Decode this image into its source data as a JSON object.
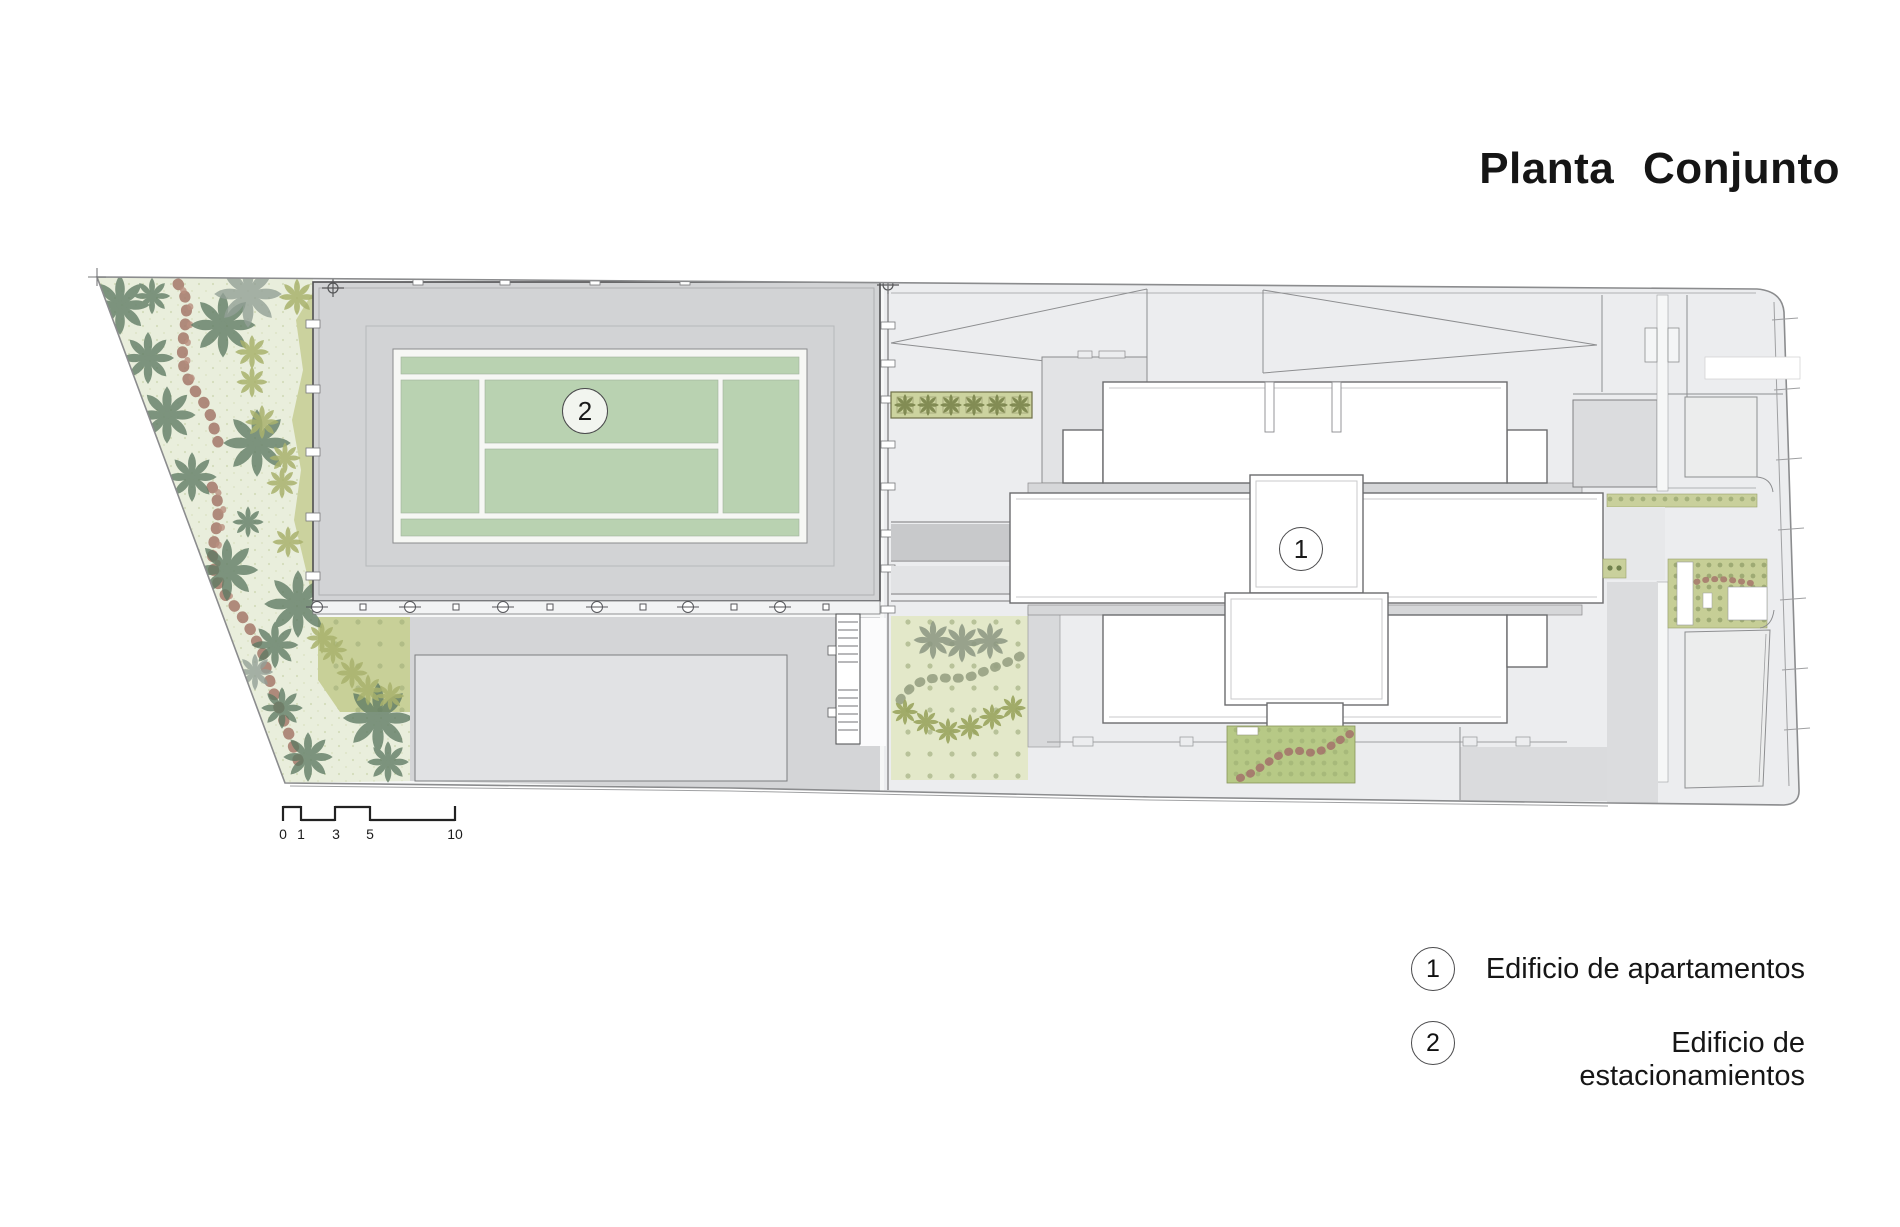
{
  "title": "Planta Conjunto",
  "plan_labels": {
    "building_1": "1",
    "building_2": "2"
  },
  "legend": {
    "items": [
      {
        "number": "1",
        "label": "Edificio de apartamentos"
      },
      {
        "number": "2",
        "label": "Edificio de estacionamientos"
      }
    ]
  },
  "scale_bar": {
    "ticks": [
      "0",
      "1",
      "3",
      "5",
      "10"
    ]
  },
  "colors": {
    "roof_gray": "#d2d3d5",
    "court_green": "#b9d2b1",
    "court_line_white": "#f6f7f4",
    "garden_pale_green": "#e9eedc",
    "hedge_olive": "#c9d09c",
    "dense_garden_olive": "#c6ce96",
    "shrub_path_red": "#a87e70",
    "plaza_gray": "#ecedef",
    "dark_band_gray": "#c8c9cb",
    "outline_gray": "#6b6c6e"
  }
}
